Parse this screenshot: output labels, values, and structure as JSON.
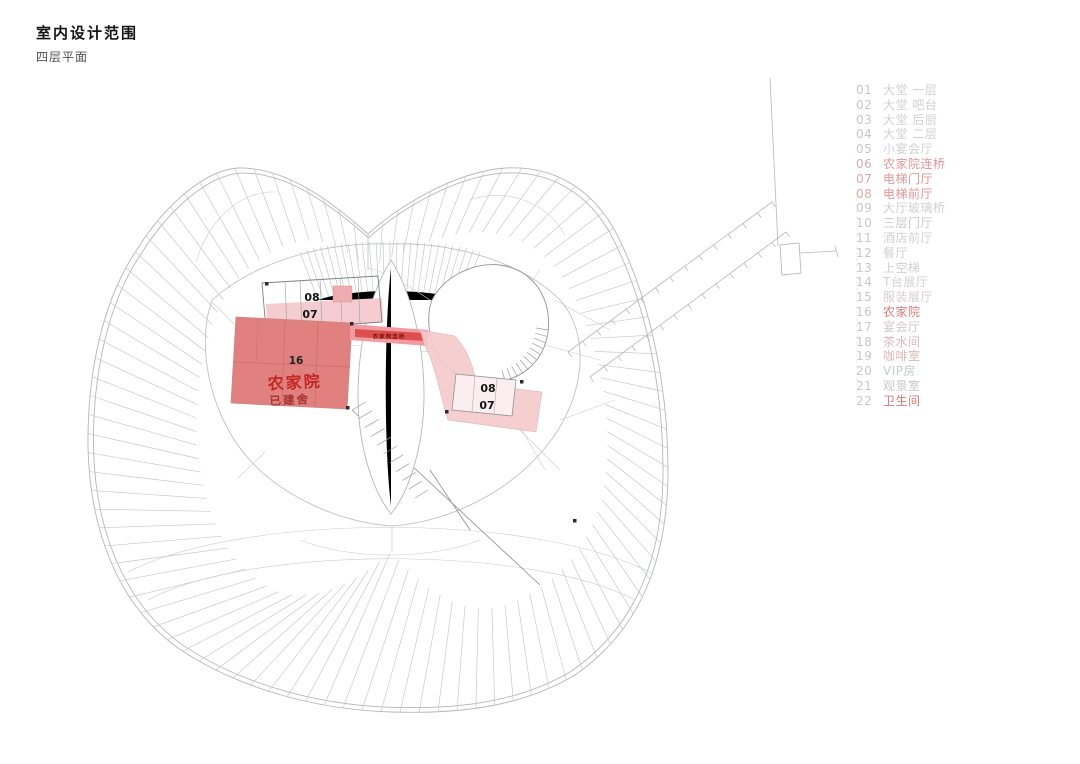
{
  "page": {
    "title": "室内设计范围",
    "subtitle": "四层平面"
  },
  "legend": {
    "items": [
      {
        "num": "01",
        "label": "大堂 一层",
        "color": "#cfd1d0",
        "num_color": "#c6c8c7"
      },
      {
        "num": "02",
        "label": "大堂 吧台",
        "color": "#cfd1d0",
        "num_color": "#c6c8c7"
      },
      {
        "num": "03",
        "label": "大堂 后厨",
        "color": "#cfd1d0",
        "num_color": "#c6c8c7"
      },
      {
        "num": "04",
        "label": "大堂 二层",
        "color": "#cfd1d0",
        "num_color": "#c6c8c7"
      },
      {
        "num": "05",
        "label": "小宴会厅",
        "color": "#cfd1d0",
        "num_color": "#c6c8c7"
      },
      {
        "num": "06",
        "label": "农家院连桥",
        "color": "#e39598",
        "num_color": "#d8a9ab"
      },
      {
        "num": "07",
        "label": "电梯门厅",
        "color": "#e39598",
        "num_color": "#d8a9ab"
      },
      {
        "num": "08",
        "label": "电梯前厅",
        "color": "#e39598",
        "num_color": "#d8a9ab"
      },
      {
        "num": "09",
        "label": "大厅玻璃桥",
        "color": "#cfd1d0",
        "num_color": "#c6c8c7"
      },
      {
        "num": "10",
        "label": "三层门厅",
        "color": "#c8cac9",
        "num_color": "#c6c8c7"
      },
      {
        "num": "11",
        "label": "酒店前厅",
        "color": "#cfd1d0",
        "num_color": "#c6c8c7"
      },
      {
        "num": "12",
        "label": "餐厅",
        "color": "#cfd1d0",
        "num_color": "#c6c8c7"
      },
      {
        "num": "13",
        "label": "上空梯",
        "color": "#cfd1d0",
        "num_color": "#c6c8c7"
      },
      {
        "num": "14",
        "label": "T台展厅",
        "color": "#cfd1d0",
        "num_color": "#c6c8c7"
      },
      {
        "num": "15",
        "label": "服装展厅",
        "color": "#d4cfcf",
        "num_color": "#c6c8c7"
      },
      {
        "num": "16",
        "label": "农家院",
        "color": "#d97a7b",
        "num_color": "#c6c8c7"
      },
      {
        "num": "17",
        "label": "宴会厅",
        "color": "#cfc8c8",
        "num_color": "#c6c8c7"
      },
      {
        "num": "18",
        "label": "茶水间",
        "color": "#dcb9ba",
        "num_color": "#c6c8c7"
      },
      {
        "num": "19",
        "label": "咖啡室",
        "color": "#dcb9ba",
        "num_color": "#c6c8c7"
      },
      {
        "num": "20",
        "label": "VIP房",
        "color": "#c8cac9",
        "num_color": "#c6c8c7"
      },
      {
        "num": "21",
        "label": "观景室",
        "color": "#cfc4c4",
        "num_color": "#c6c8c7"
      },
      {
        "num": "22",
        "label": "卫生间",
        "color": "#d97a7b",
        "num_color": "#c6c8c7"
      }
    ]
  },
  "plan": {
    "labels": {
      "elev_top_08": "08",
      "elev_top_07": "07",
      "elev_mid_08": "08",
      "elev_mid_07": "07",
      "block_no": "16",
      "block_name": "农家院",
      "block_sub": "已建舍",
      "bridge": "农家院连桥"
    },
    "colors": {
      "farmhouse_fill": "#e0817f",
      "bridge_fill": "#ef9ba1",
      "bridge_stripe": "#dd4f4f",
      "corridor_fill": "#f4c9cc",
      "lobby_pink": "#f5cdd0",
      "drawing_line": "#b9bcbd",
      "label_black": "#141414",
      "block_name_red": "#c32723",
      "block_sub_red": "#a23330"
    }
  }
}
